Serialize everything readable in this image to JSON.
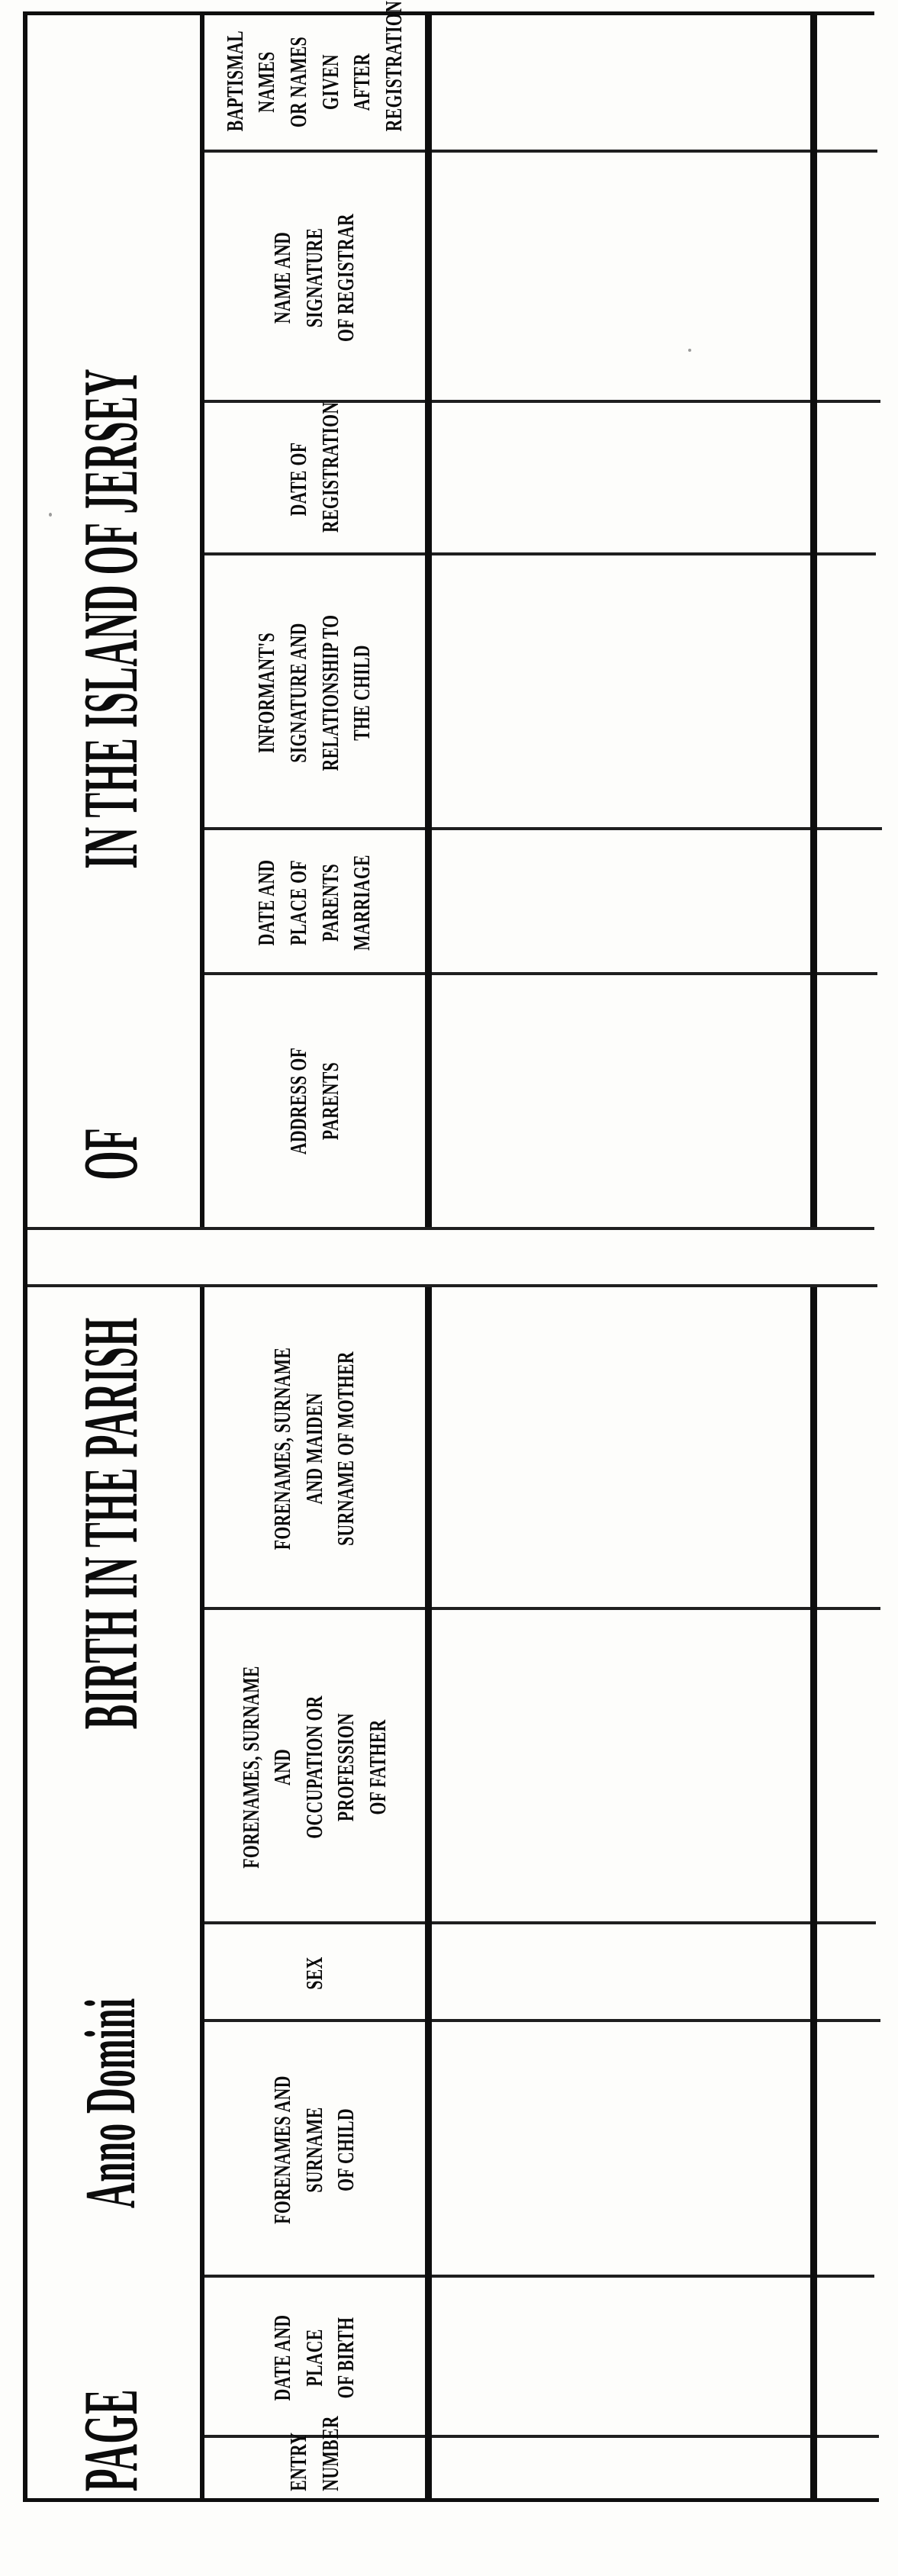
{
  "page": {
    "kind": "scanned birth register form",
    "titles": {
      "page": "PAGE",
      "anno_domini": "Anno Domini",
      "parish": "BIRTH IN THE PARISH",
      "of": "OF",
      "island": "IN THE ISLAND OF JERSEY"
    },
    "columns": [
      {
        "id": "entry-number",
        "label": "ENTRY\nNUMBER"
      },
      {
        "id": "date-place-of-birth",
        "label": "DATE AND\nPLACE\nOF BIRTH"
      },
      {
        "id": "child-name",
        "label": "FORENAMES AND SURNAME\nOF CHILD"
      },
      {
        "id": "sex",
        "label": "SEX"
      },
      {
        "id": "father",
        "label": "FORENAMES, SURNAME AND\nOCCUPATION OR PROFESSION\nOF FATHER"
      },
      {
        "id": "mother",
        "label": "FORENAMES, SURNAME AND MAIDEN\nSURNAME OF MOTHER"
      },
      {
        "id": "address-of-parents",
        "label": "ADDRESS OF PARENTS"
      },
      {
        "id": "parents-marriage",
        "label": "DATE AND\nPLACE OF PARENTS\nMARRIAGE"
      },
      {
        "id": "informant",
        "label": "INFORMANT'S SIGNATURE AND\nRELATIONSHIP TO THE CHILD"
      },
      {
        "id": "date-of-registration",
        "label": "DATE OF\nREGISTRATION"
      },
      {
        "id": "registrar",
        "label": "NAME AND SIGNATURE\nOF REGISTRAR"
      },
      {
        "id": "baptismal-names",
        "label": "BAPTISMAL NAMES\nOR NAMES GIVEN\nAFTER\nREGISTRATION"
      }
    ],
    "blank_row_count": 2,
    "colors": {
      "ink": "#0e0e0e",
      "paper": "#fdfdfb"
    }
  }
}
